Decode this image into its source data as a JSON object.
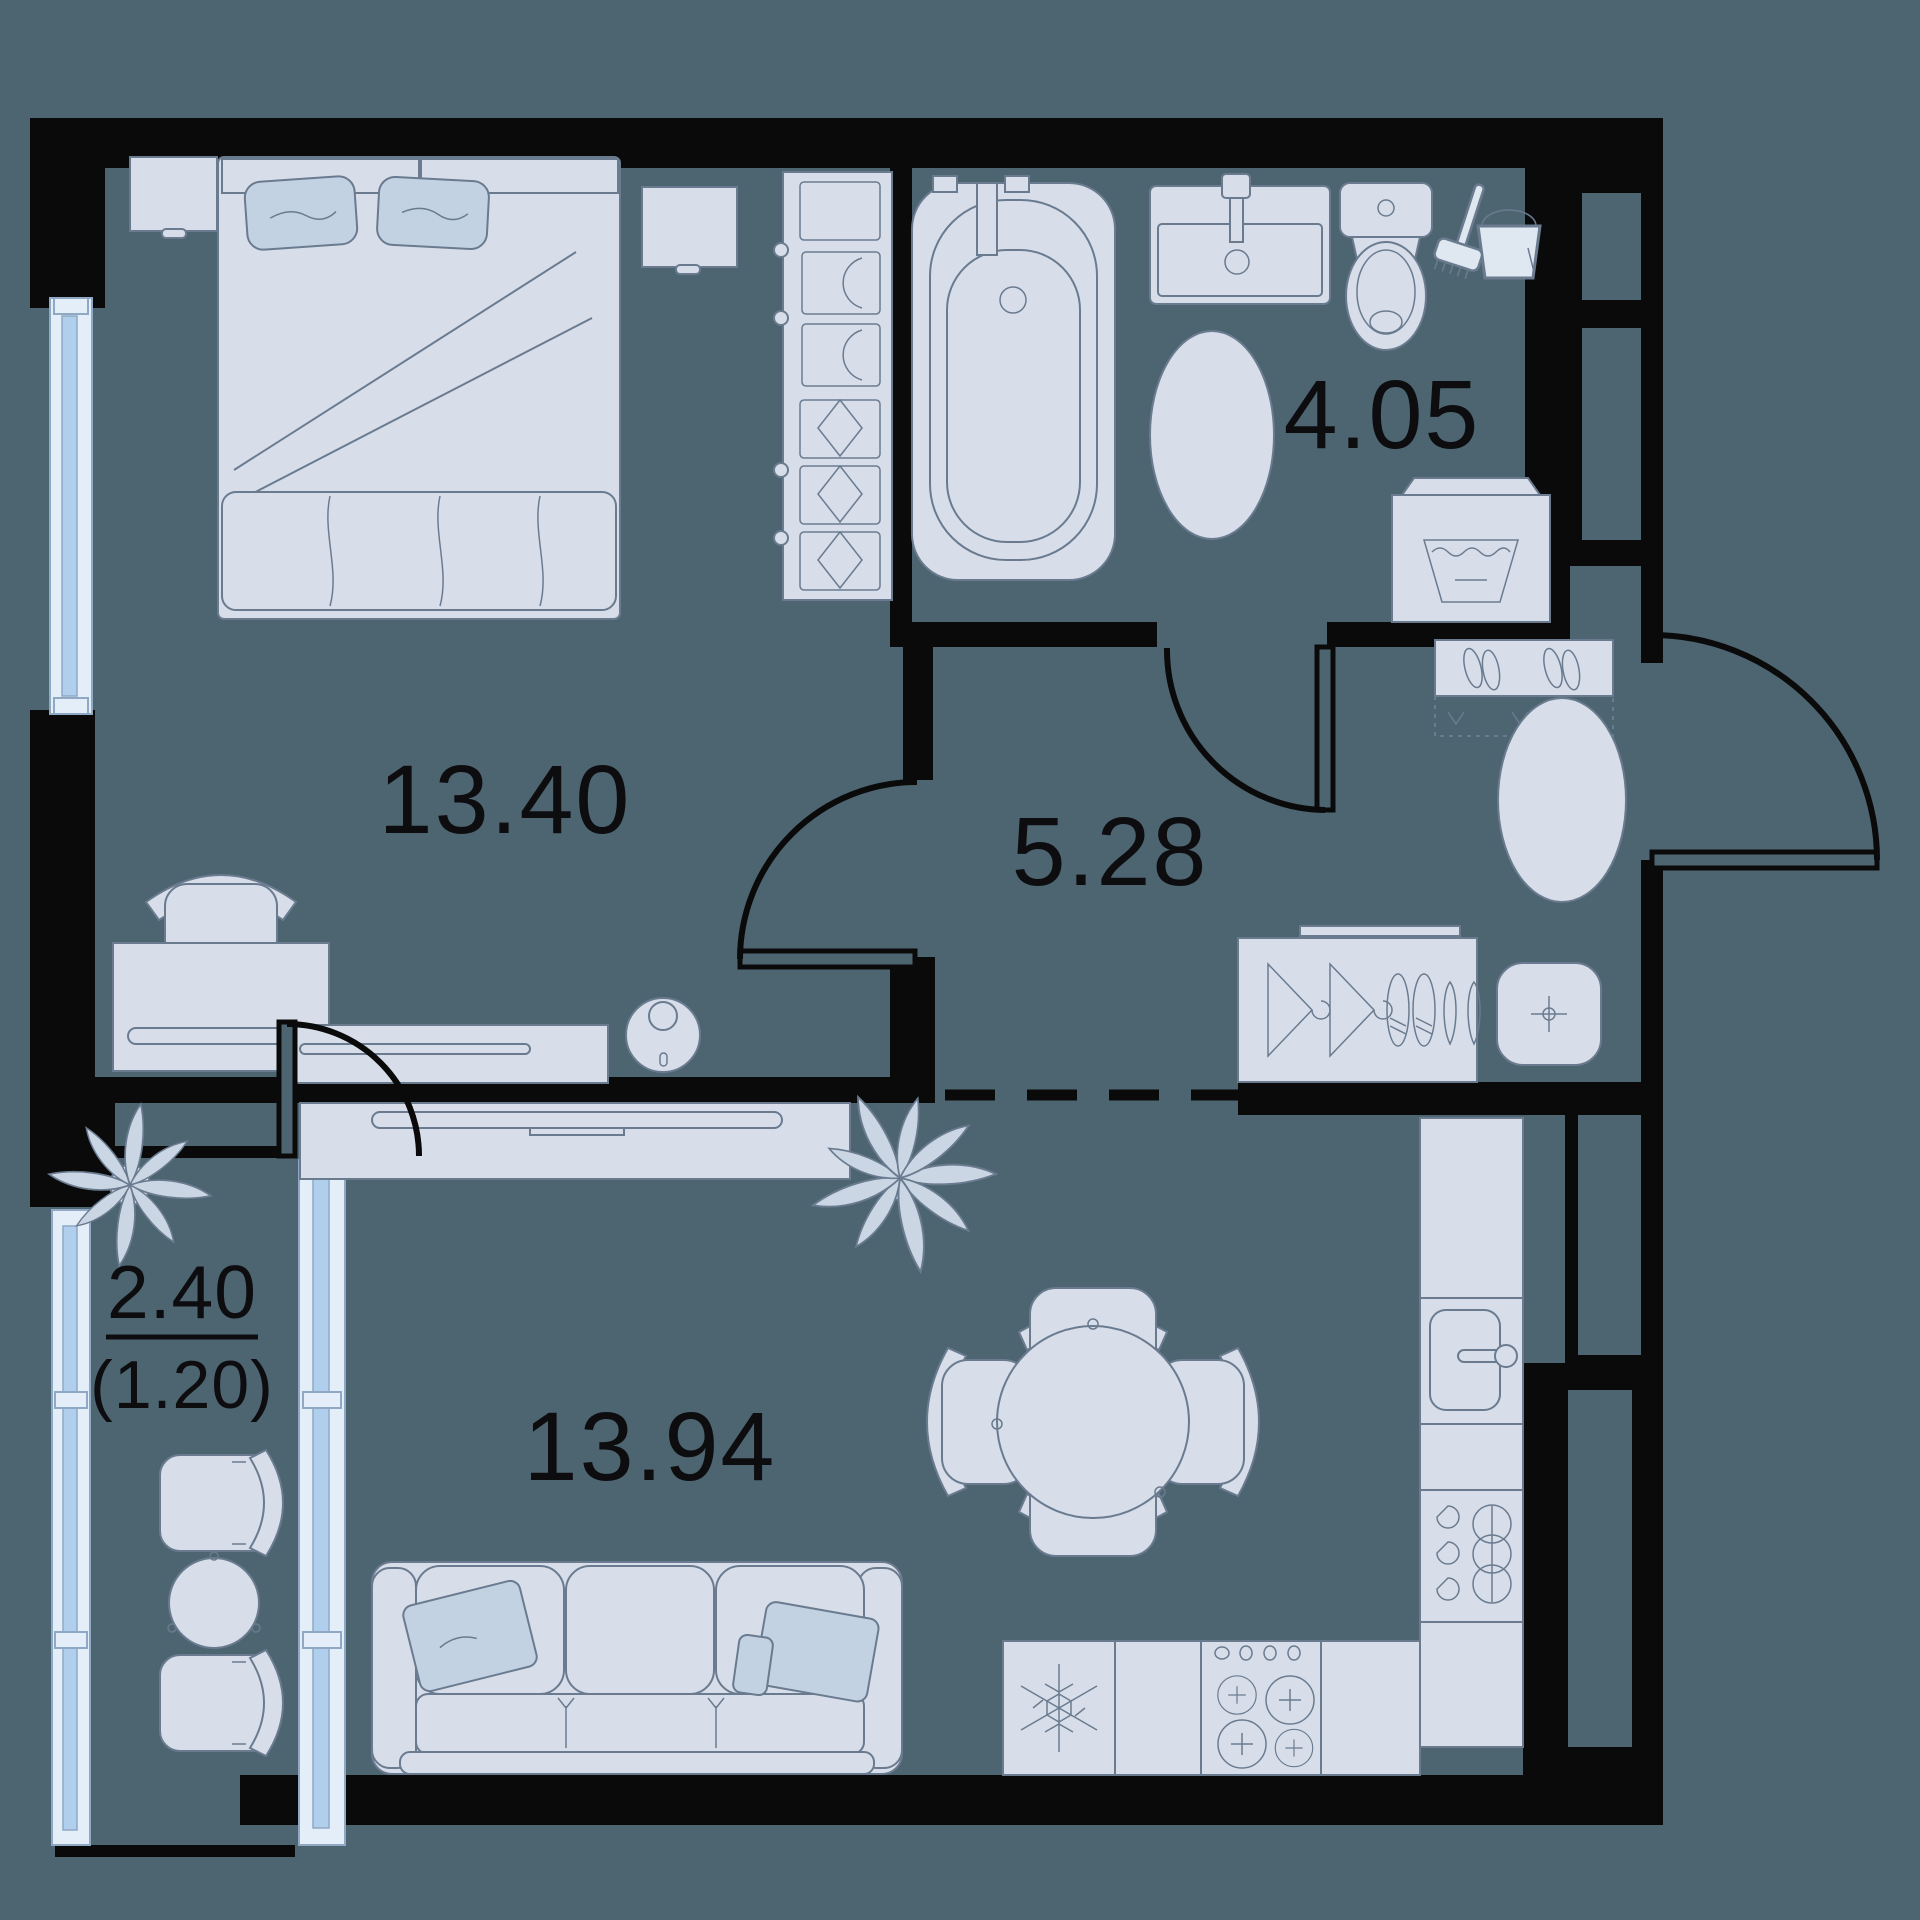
{
  "plan": {
    "type": "apartment-floor-plan",
    "colors": {
      "background": "#4D6571",
      "walls": "#0A0A0B",
      "furniture_fill": "#D7DEE9",
      "furniture_stroke": "#6A7B90",
      "textile_accent": "#C3D2E2",
      "window_glass": "#AFCFEC",
      "window_frame": "#E4EEF8",
      "label_text": "#0D0D0F"
    },
    "rooms": {
      "bedroom": {
        "label": "13.40"
      },
      "bathroom": {
        "label": "4.05"
      },
      "hallway": {
        "label": "5.28"
      },
      "living_kitchen": {
        "label": "13.94"
      },
      "balcony": {
        "label": "2.40",
        "label_reduced": "(1.20)"
      }
    },
    "icons": [
      "double-bed",
      "pillow",
      "nightstand",
      "wardrobe-shelves",
      "desk",
      "desk-chair",
      "dresser",
      "robot-vacuum-icon",
      "bathtub",
      "bathroom-sink",
      "toilet",
      "mop-bucket-icon",
      "bath-rug",
      "washing-machine-icon",
      "shoe-rack",
      "hallway-rug",
      "closet-hangers",
      "shoes",
      "pouf",
      "tv-stand",
      "tv",
      "plant-icon",
      "dining-table",
      "dining-chair",
      "sofa",
      "fridge-snowflake-icon",
      "cooktop-burners-icon",
      "kitchen-sink",
      "kitchen-counter",
      "window",
      "door-swing-arc",
      "vent-shaft",
      "zone-divider-dashed-line"
    ]
  }
}
